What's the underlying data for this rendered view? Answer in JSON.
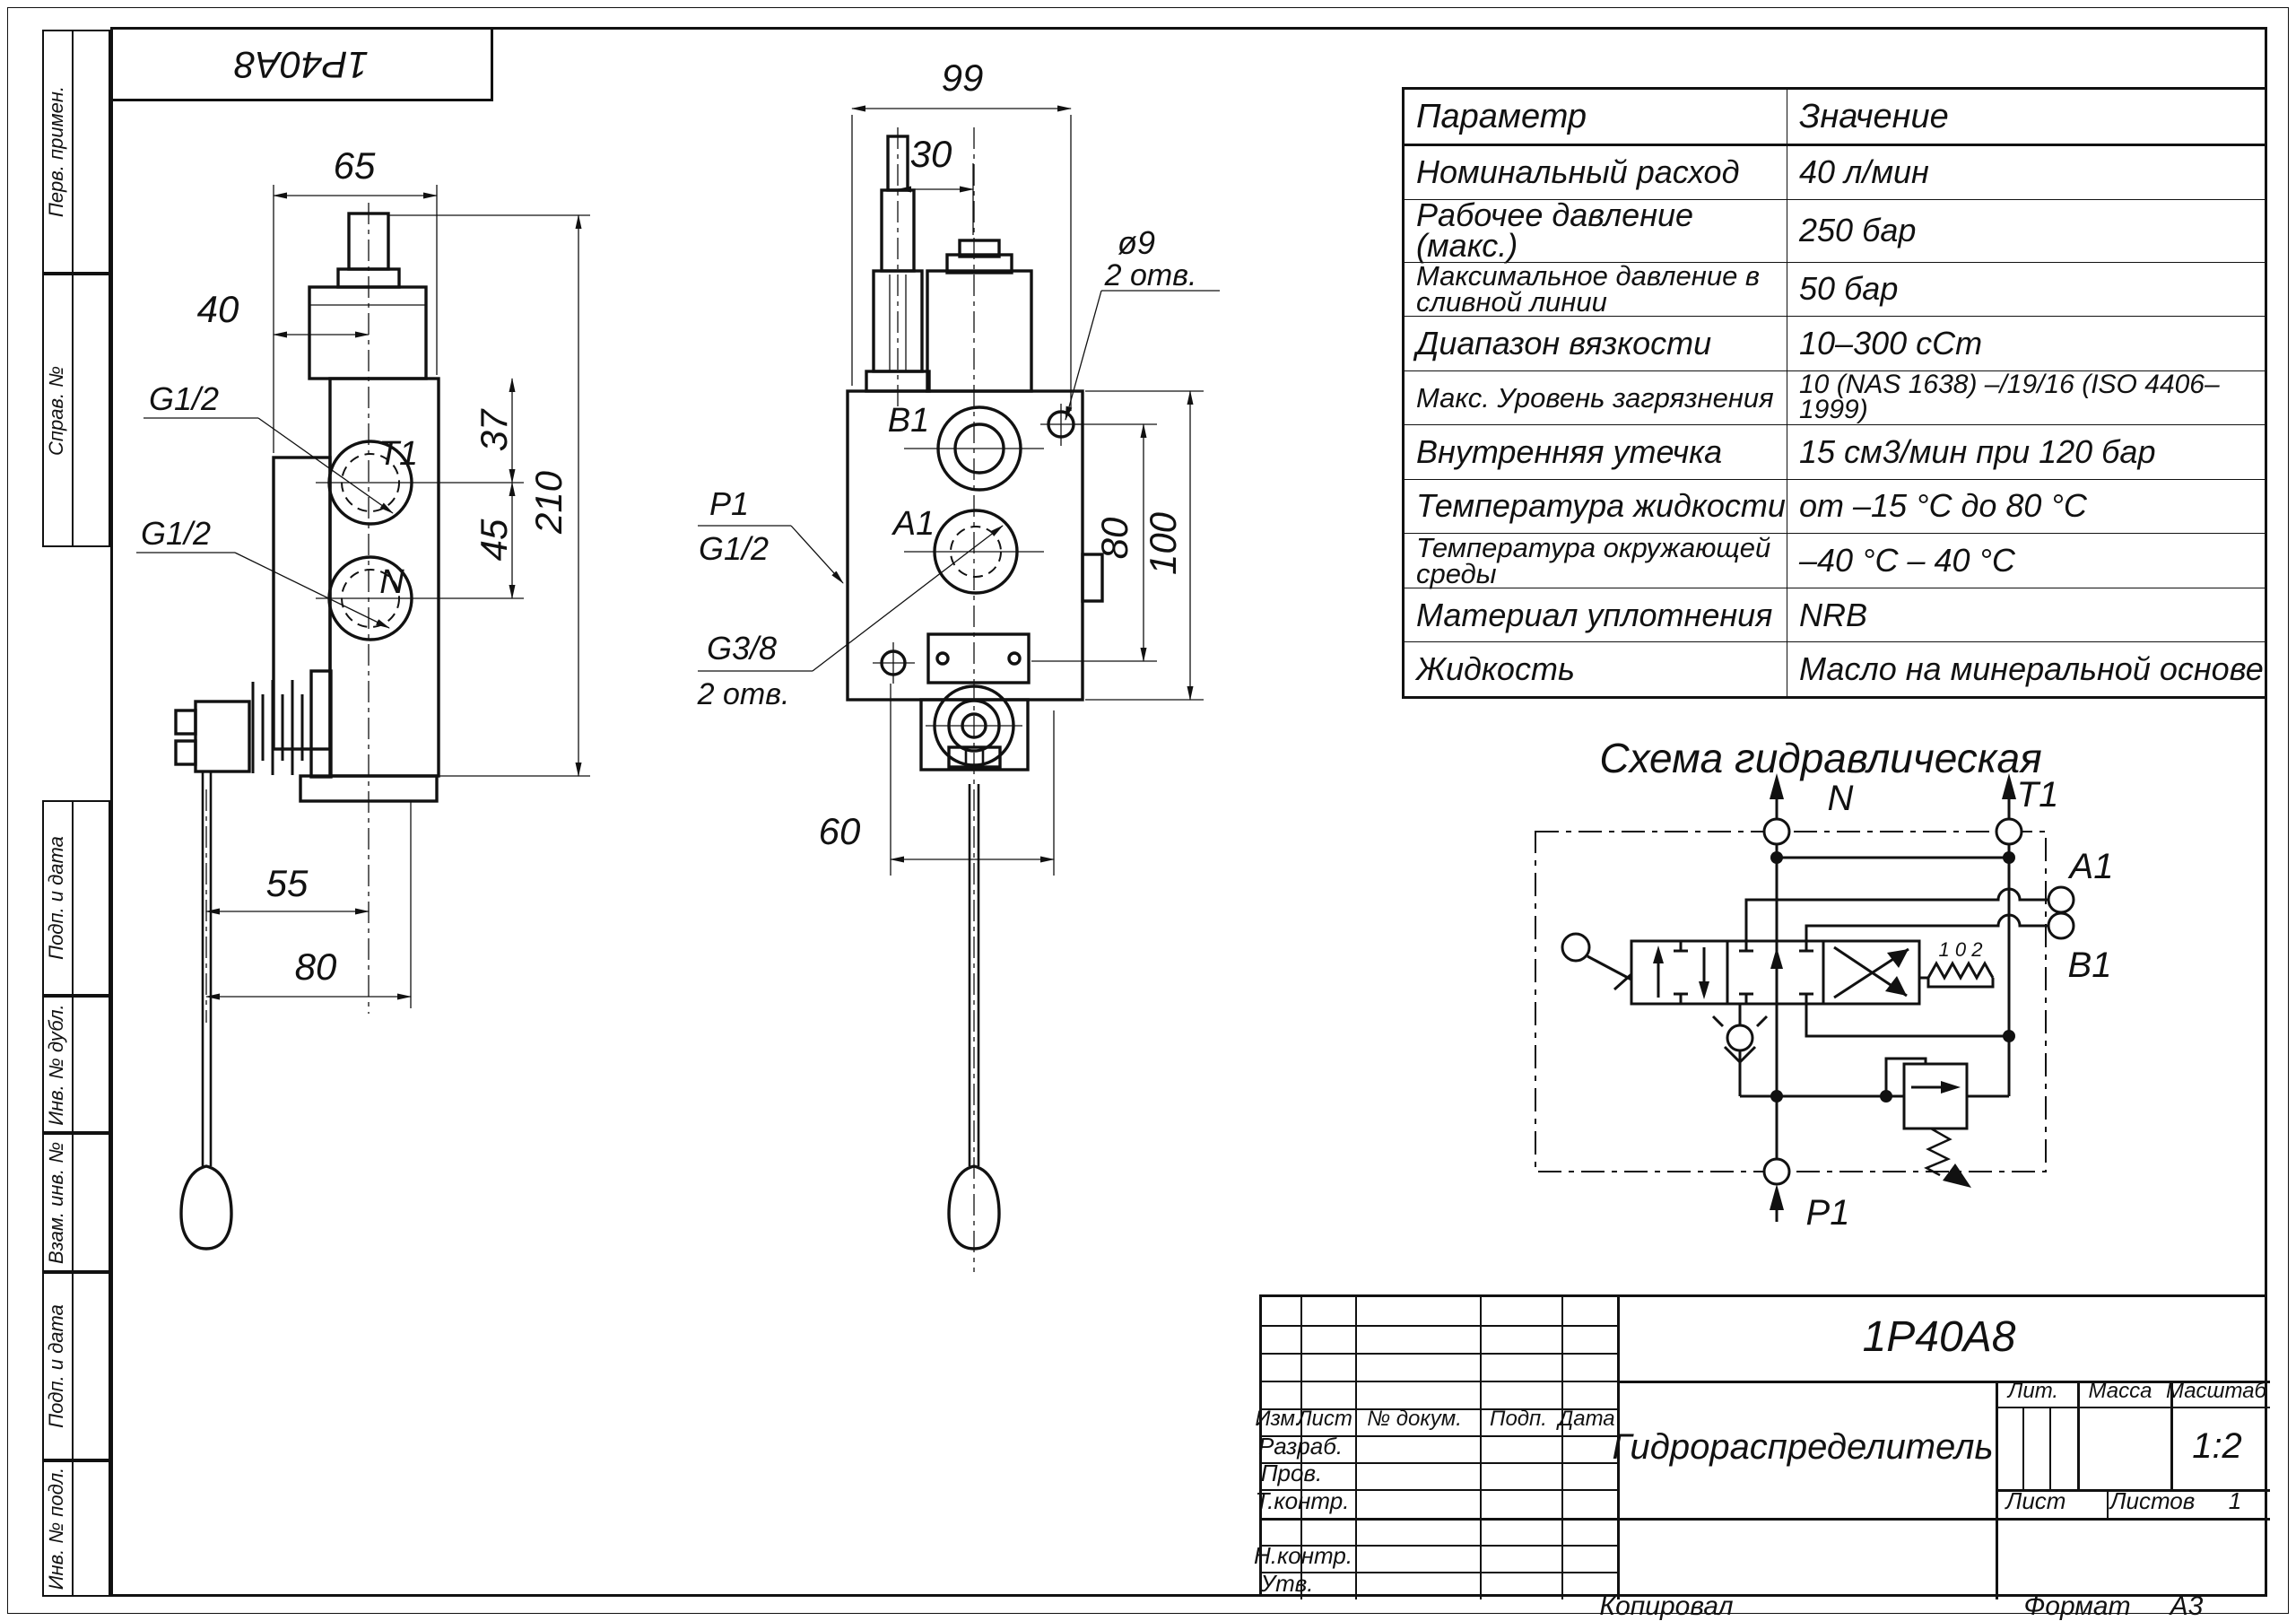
{
  "stamp": {
    "code": "1P40A8"
  },
  "margin": {
    "labels": [
      "Перв. примен.",
      "Справ. №",
      "Подп. и дата",
      "Инв. № дубл.",
      "Взам. инв. №",
      "Подп. и дата",
      "Инв. № подл."
    ]
  },
  "side_view": {
    "dim_width": "65",
    "dim_center": "40",
    "dim_port1": "37",
    "dim_port2": "45",
    "dim_height": "210",
    "dim_lever1": "55",
    "dim_lever2": "80",
    "port_top": "T1",
    "port_bottom": "N",
    "thread_top": "G1/2",
    "thread_bottom": "G1/2"
  },
  "front_view": {
    "dim_width": "99",
    "dim_fitting": "30",
    "dim_holes": "80",
    "dim_height": "100",
    "dim_lever": "60",
    "port_top": "B1",
    "port_bottom": "A1",
    "p_label": "P1",
    "p_thread": "G1/2",
    "drain_thread": "G3/8",
    "drain_note": "2 отв.",
    "hole_dia": "ø9",
    "hole_note": "2 отв."
  },
  "parameters_table": {
    "col_param": "Параметр",
    "col_value": "Значение",
    "rows": [
      {
        "p": "Номинальный расход",
        "v": "40 л/мин"
      },
      {
        "p": "Рабочее давление (макс.)",
        "v": "250 бар"
      },
      {
        "p": "Максимальное давление в сливной линии",
        "v": "50 бар"
      },
      {
        "p": "Диапазон вязкости",
        "v": "10–300 сСт"
      },
      {
        "p": "Макс. Уровень загрязнения",
        "v": "10 (NAS 1638) –/19/16 (ISO 4406–1999)"
      },
      {
        "p": "Внутренняя утечка",
        "v": "15 см3/мин при 120 бар"
      },
      {
        "p": "Температура жидкости",
        "v": "от –15 °С до 80 °С"
      },
      {
        "p": "Температура окружающей среды",
        "v": "–40 °С – 40 °С"
      },
      {
        "p": "Материал уплотнения",
        "v": "NRB"
      },
      {
        "p": "Жидкость",
        "v": "Масло на минеральной основе"
      }
    ]
  },
  "schematic": {
    "title": "Схема гидравлическая",
    "port_n": "N",
    "port_t1": "T1",
    "port_a1": "A1",
    "port_b1": "B1",
    "port_p1": "P1",
    "detents": "1 0 2"
  },
  "title_block": {
    "designation": "1P40A8",
    "name": "Гидрораспределитель",
    "col_izm": "Изм.",
    "col_list": "Лист",
    "col_ndoc": "№ докум.",
    "col_podp": "Подп.",
    "col_data": "Дата",
    "row_razrab": "Разраб.",
    "row_prov": "Пров.",
    "row_tkontr": "Т.контр.",
    "row_nkontr": "Н.контр.",
    "row_utv": "Утв.",
    "lit": "Лит.",
    "massa": "Масса",
    "masshtab": "Масштаб",
    "scale": "1:2",
    "list": "Лист",
    "listov": "Листов",
    "listov_val": "1"
  },
  "footer": {
    "copied": "Копировал",
    "format_label": "Формат",
    "format_value": "А3"
  }
}
